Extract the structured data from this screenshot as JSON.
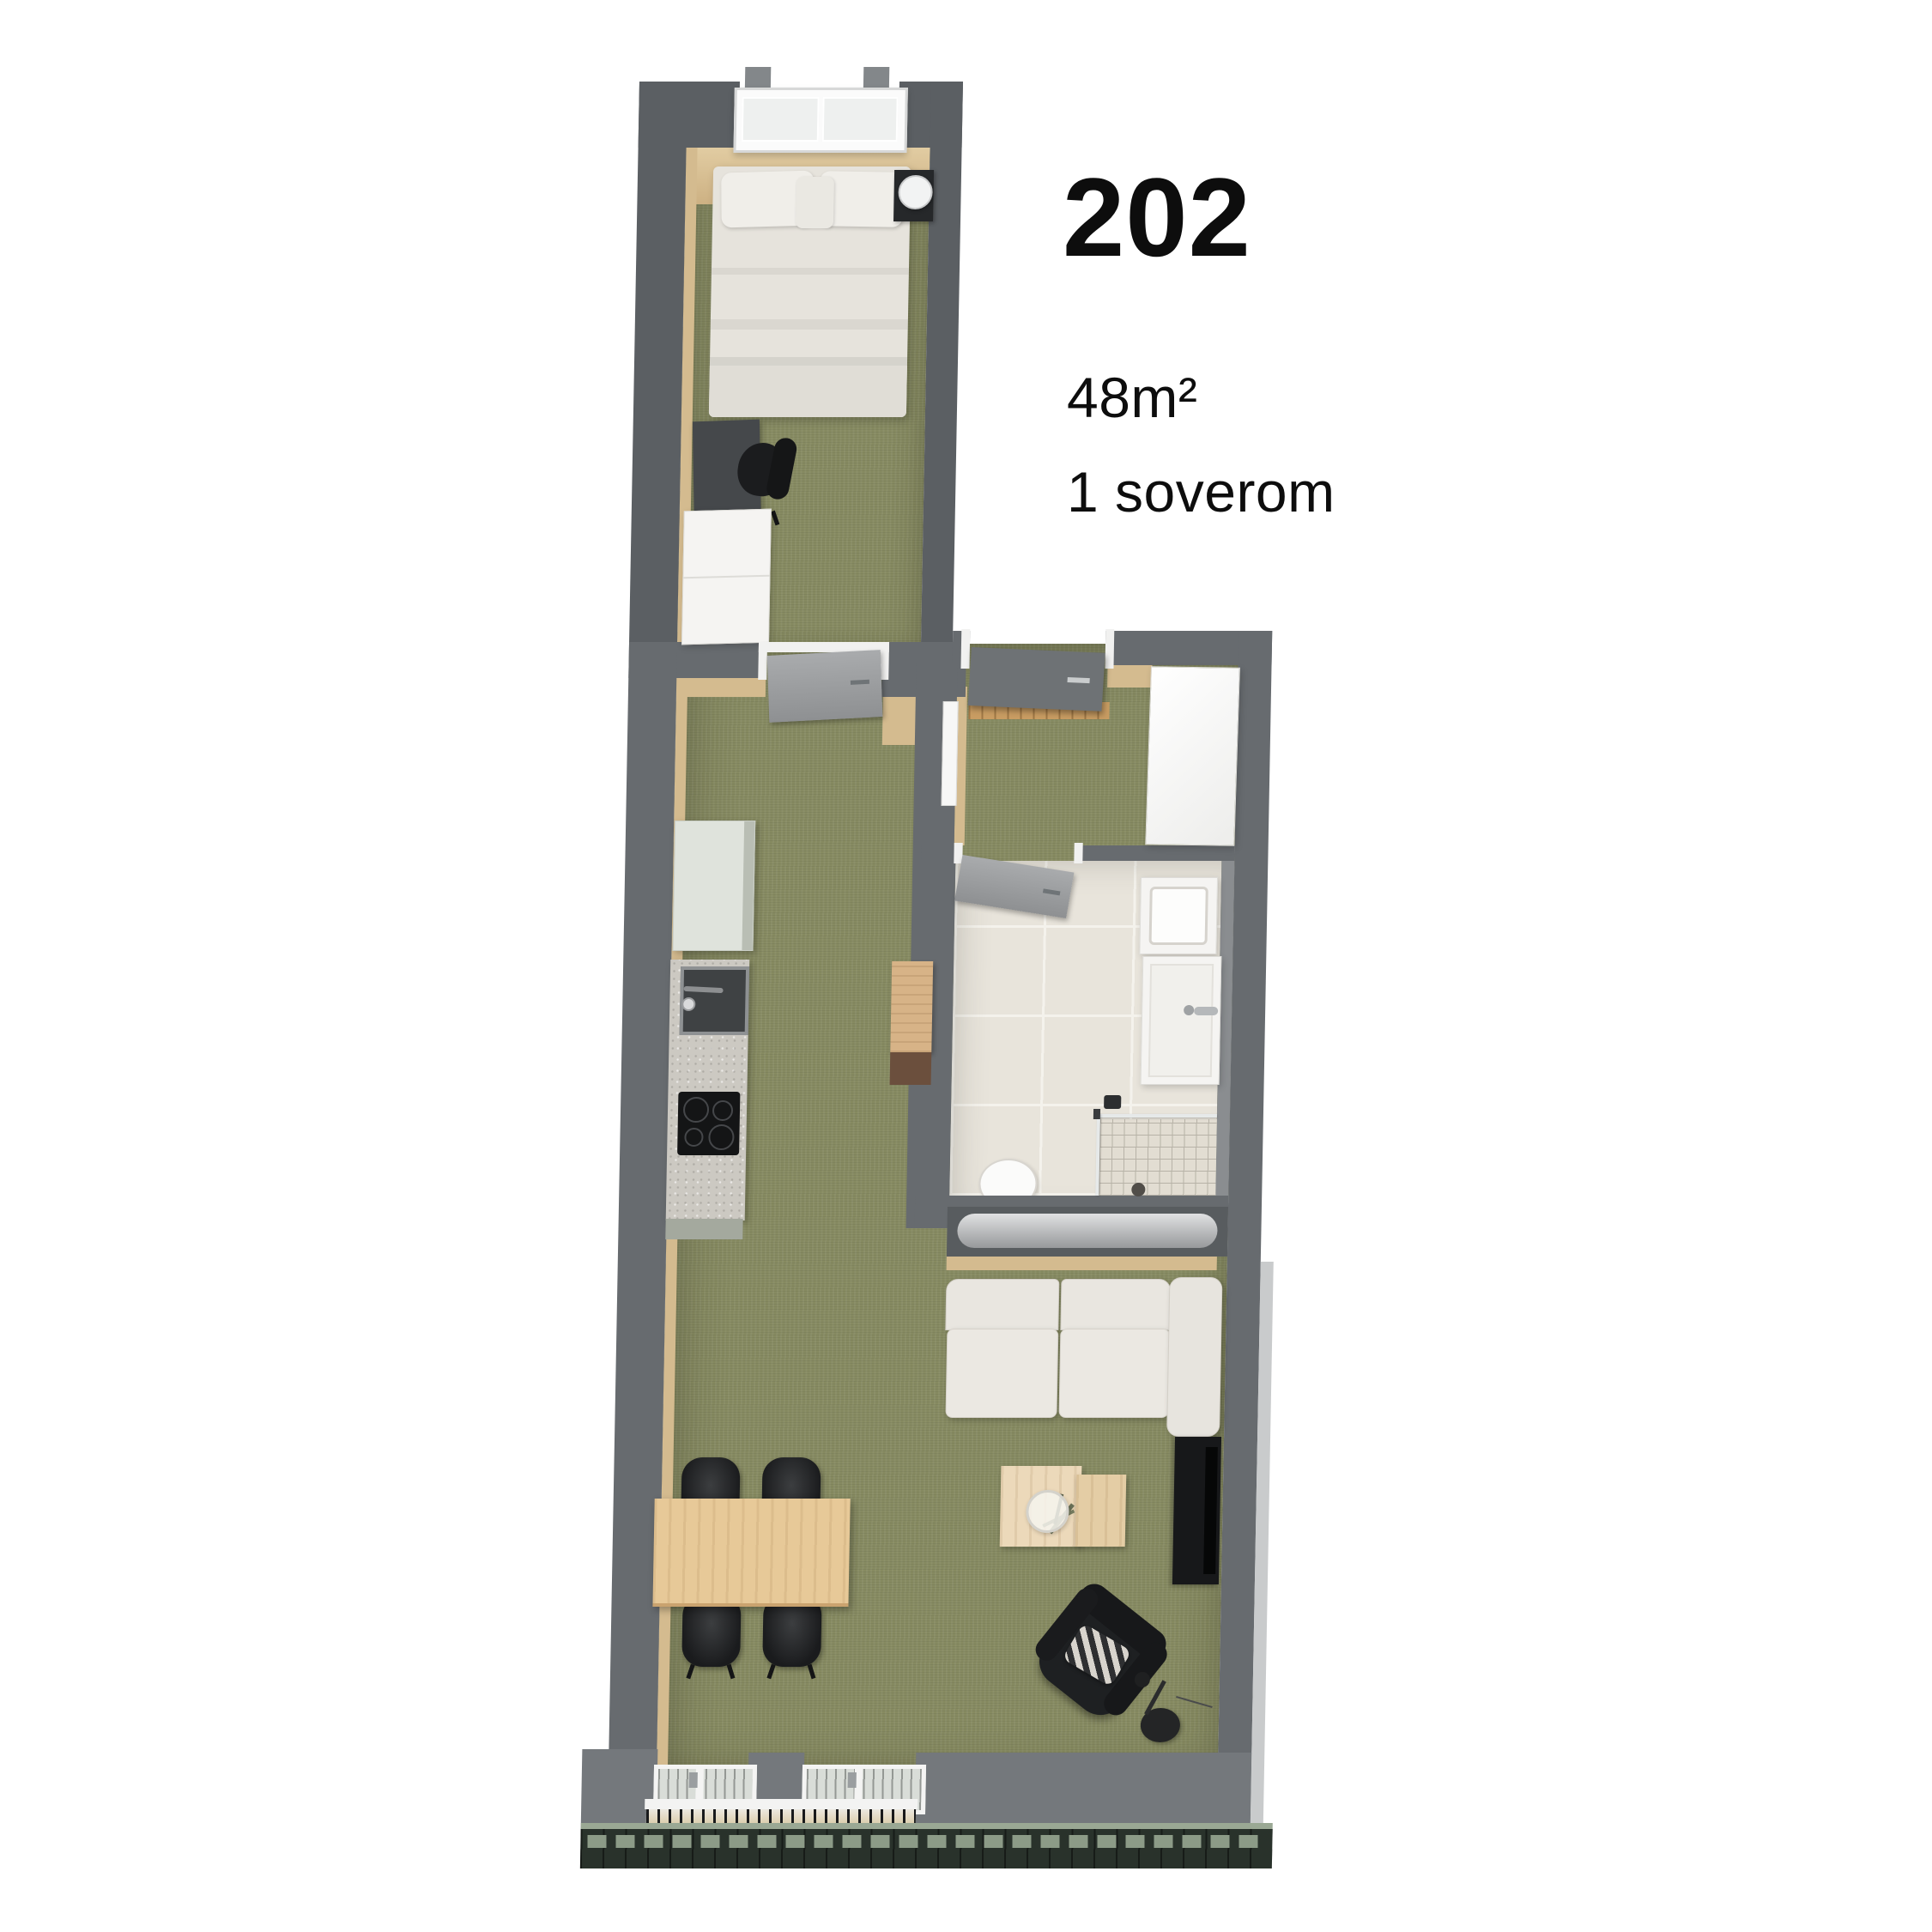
{
  "header": {
    "unit_number": "202",
    "area": "48m²",
    "bedrooms": "1 soverom"
  },
  "plan": {
    "type": "apartment-floor-plan-3d-top-view",
    "rooms": [
      "bedroom",
      "hall",
      "bathroom",
      "kitchen-living-room"
    ]
  },
  "colors": {
    "background": "#ffffff",
    "text": "#0d0d0d",
    "wall": "#676b6f",
    "wall_dark": "#5b5f63",
    "wall_light": "#74787c",
    "wall_face_beige": "#d4bb8f",
    "floor_olive": "#868a61",
    "tile": "#e8e4db",
    "grout": "#f4f2ec",
    "mosaic": "#e2ddd2",
    "mosaic_line": "#b7b2a7",
    "furniture_white": "#f5f4f2",
    "bed_linen": "#e6e3dc",
    "sofa": "#e9e6e0",
    "stone_counter": "#ccc9c2",
    "kitchen_cabinet": "#dfe3dc",
    "wood_light": "#e7c998",
    "wood_mid": "#d7b387",
    "wood_dark": "#6b4f3d",
    "black_furniture": "#1e2022",
    "entry_door": "#6e7275",
    "facade_dark": "#29322b",
    "facade_green": "#9aa894"
  }
}
